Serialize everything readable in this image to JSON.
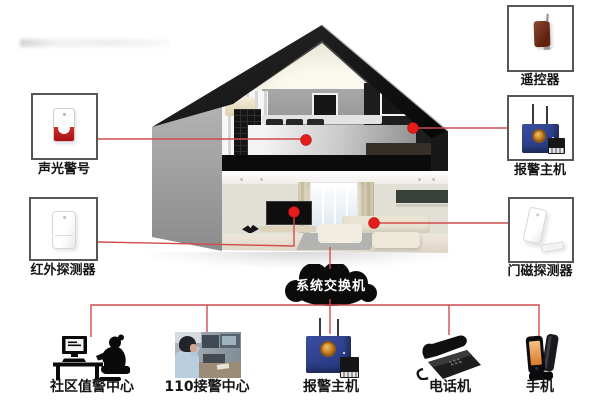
{
  "cloud": {
    "label": "系统交换机",
    "icon": "cloud-icon",
    "fill_color": "#0b0b0b",
    "text_color": "#ffffff"
  },
  "house": {
    "icon": "house-cutaway-illustration"
  },
  "left_devices": [
    {
      "label": "声光警号",
      "icon": "siren-icon"
    },
    {
      "label": "红外探测器",
      "icon": "pir-detector-icon"
    }
  ],
  "right_devices": [
    {
      "label": "遥控器",
      "icon": "remote-control-icon"
    },
    {
      "label": "报警主机",
      "icon": "alarm-host-icon"
    },
    {
      "label": "门磁探测器",
      "icon": "door-sensor-icon"
    }
  ],
  "bottom_nodes": [
    {
      "label": "社区值警中心",
      "icon": "community-duty-center-icon"
    },
    {
      "label": "110接警中心",
      "icon": "call-center-photo"
    },
    {
      "label": "报警主机",
      "icon": "alarm-host-icon"
    },
    {
      "label": "电话机",
      "icon": "desk-phone-icon"
    },
    {
      "label": "手机",
      "icon": "mobile-phone-icon"
    }
  ],
  "colors": {
    "connection_line": "#d24a4a",
    "sensor_dot": "#e51c1c",
    "roof_black": "#141414",
    "wall_gray": "#9e9e9e",
    "host_blue": "#2e3f93",
    "badge_gold": "#d99a30",
    "siren_red": "#ce2222",
    "remote_brown": "#6f3020",
    "phone_screen_orange": "#e89a50",
    "box_border": "#565656",
    "background": "#ffffff"
  }
}
